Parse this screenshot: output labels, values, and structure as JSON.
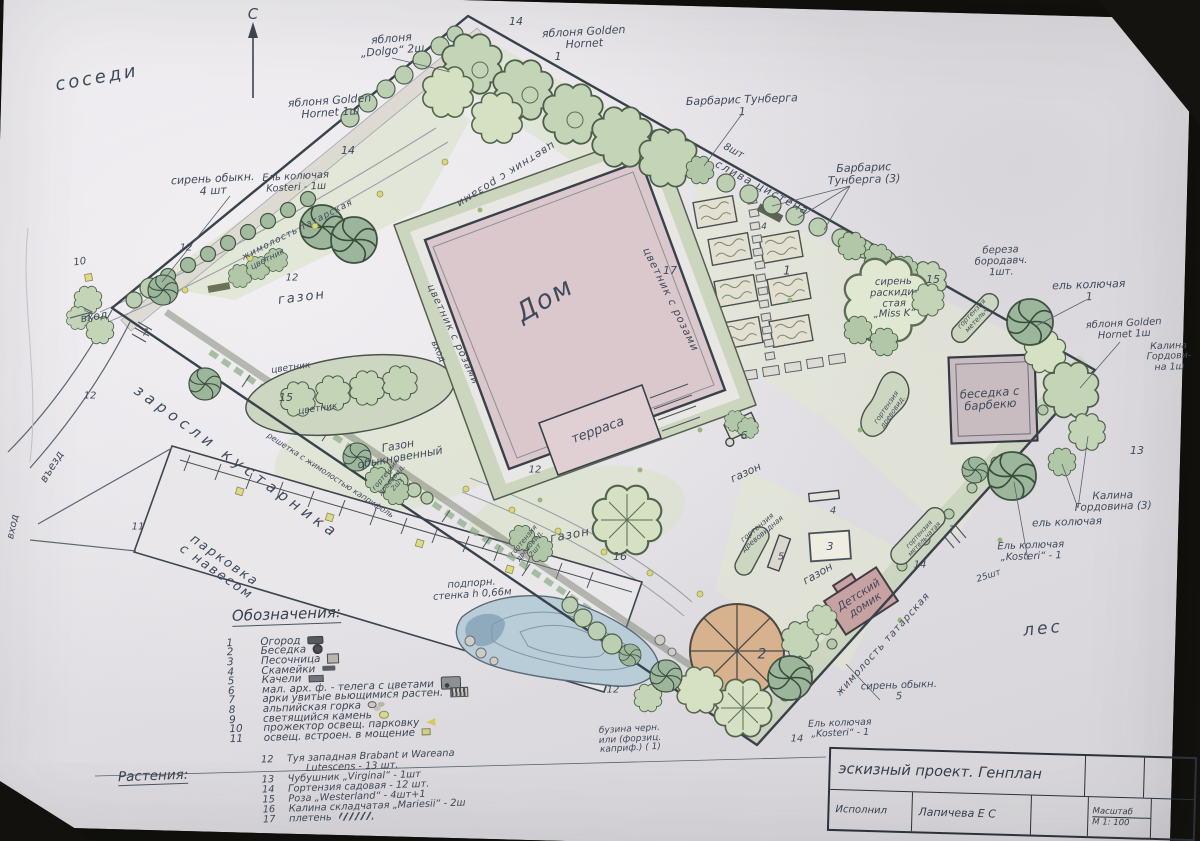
{
  "palette": {
    "paper": "#e9e7ea",
    "pencil": "#414a5b",
    "plant_green": "#bccfb2",
    "water": "#b9cdd9",
    "house_pink": "#dbc8cc",
    "gazebo_tan": "#d8b28e",
    "kids_pink": "#c8a2a2"
  },
  "labels": {
    "north_c": "С",
    "neighbors": "соседи",
    "apple_dolgo": "яблоня\n„Dolgo“ 2ш",
    "n14_top": "14",
    "apple_golden_top": "яблоня Golden\nHornet",
    "n1_top": "1",
    "apple_golden_left": "яблоня Golden\nHornet 1ш",
    "n14_left": "14",
    "spruce_kosteri_nw": "Ель колючая\nKosteri - 1ш",
    "lilac_4": "сирень обыкн.\n4 шт",
    "barberry_1": "Барбарис Тунберга\n1",
    "n8sht": "8шт",
    "plum": "слива цистена",
    "barberry_3": "Барбарис\nТунберга (3)",
    "birch": "береза\nбородавч.\n1шт.",
    "lilac_missk": "сирень\nраскиди-\nстая\n„Miss K“",
    "n15_r": "15",
    "spruce_blue_r": "ель колючая\n1",
    "apple_golden_r": "яблоня Golden\nHornet 1ш",
    "viburnum_1": "Калина\nГордови-\nна 1ш",
    "n13": "13",
    "viburnum_3": "Калина\nГордовина (3)",
    "spruce_blue_2": "ель колючая",
    "spruce_kosteri_se": "Ель колючая\n„Kosteri“ - 1",
    "n25sht": "25шт",
    "bbq_label": "беседка с\nбарбекю",
    "forest": "лес",
    "lilac_5": "сирень обыкн.\n5",
    "spruce_kosteri_s": "Ель колючая\n„Kosteri“ - 1",
    "n14_s": "14",
    "n2": "2",
    "gazon_play": "газон",
    "kids_house": "Детский\nдомик",
    "honeysuckle_se": "жимолость татарская",
    "n3": "3",
    "n4_play": "4",
    "n5": "5",
    "hydr1": "гортензия\nдревовидная",
    "gazon_c": "газон",
    "n6": "6",
    "n1_garden": "1",
    "n17_c": "17",
    "n4_top": "4",
    "dom": "Дом",
    "terrace": "терраса",
    "rose_top": "цветник с розами",
    "rose_right": "цветник с розами",
    "rose_left": "цветник с розами",
    "entry_house": "вход",
    "gazon_nw": "газон",
    "flower_oval_a": "цветник",
    "flower_oval_b": "цветник",
    "n15_oval": "15",
    "gazon_ord": "Газон\nобыкновенный",
    "thicket": "заросли кустарника",
    "parking_lbl": "парковка\nс навесом",
    "n11": "11",
    "entry_drive": "въезд",
    "entry_walk": "вход",
    "entry_main": "вход",
    "n10": "10",
    "n12_a": "12",
    "n12_b": "12",
    "n7_w": "7",
    "n12_c": "12",
    "honeysuckle_nw": "жимолость татарская",
    "flower_nw": "цветник",
    "trellis": "решетка с жимолостью каприфоль",
    "wall": "подпорн.\nстенка h 0,66м",
    "gazon_mid": "газон",
    "n16": "16",
    "hydr2": "гортензия\nдревовид.\n2шт",
    "hydr3": "гортензия\nдревовид.\n2шт",
    "n12_d": "12",
    "n12_e": "12",
    "elder": "бузина черн.\nили (форзиц.\nкаприф.) ( 1)",
    "n14_se": "14",
    "n7_se": "7",
    "hydr_pan1": "гортензия\nметельч.",
    "hydr_pan2": "гортензия\nметельчатая",
    "hydr_kidney": "гортензия\nдревовид."
  },
  "legend": {
    "heading": "Обозначения:",
    "items": [
      {
        "n": "1",
        "t": "Огород"
      },
      {
        "n": "2",
        "t": "Беседка"
      },
      {
        "n": "3",
        "t": "Песочница"
      },
      {
        "n": "4",
        "t": "Скамейки"
      },
      {
        "n": "5",
        "t": "Качели"
      },
      {
        "n": "6",
        "t": "мал. арх. ф. - телега с цветами"
      },
      {
        "n": "7",
        "t": "арки увитые вьющимися растен."
      },
      {
        "n": "8",
        "t": "альпийская горка"
      },
      {
        "n": "9",
        "t": "светящийся камень"
      },
      {
        "n": "10",
        "t": "прожектор освещ. парковку"
      },
      {
        "n": "11",
        "t": "освещ. встроен. в мощение"
      }
    ]
  },
  "plants": {
    "heading": "Растения:",
    "items": [
      {
        "n": "12",
        "t": "Туя западная Brabant и Wareana\n      Lutescens - 13 шт."
      },
      {
        "n": "13",
        "t": "Чубушник „Virginal“ - 1шт"
      },
      {
        "n": "14",
        "t": "Гортензия садовая - 12 шт."
      },
      {
        "n": "15",
        "t": "Роза „Westerland“ - 4шт+1"
      },
      {
        "n": "16",
        "t": "Калина складчатая „Mariesii“ - 2ш"
      },
      {
        "n": "17",
        "t": "плетень"
      }
    ]
  },
  "title_block": {
    "title": "эскизный проект. Генплан",
    "executor_label": "Исполнил",
    "executor_name": "Лапичева Е С",
    "scale_label": "Масштаб",
    "scale_value": "М 1: 100"
  }
}
